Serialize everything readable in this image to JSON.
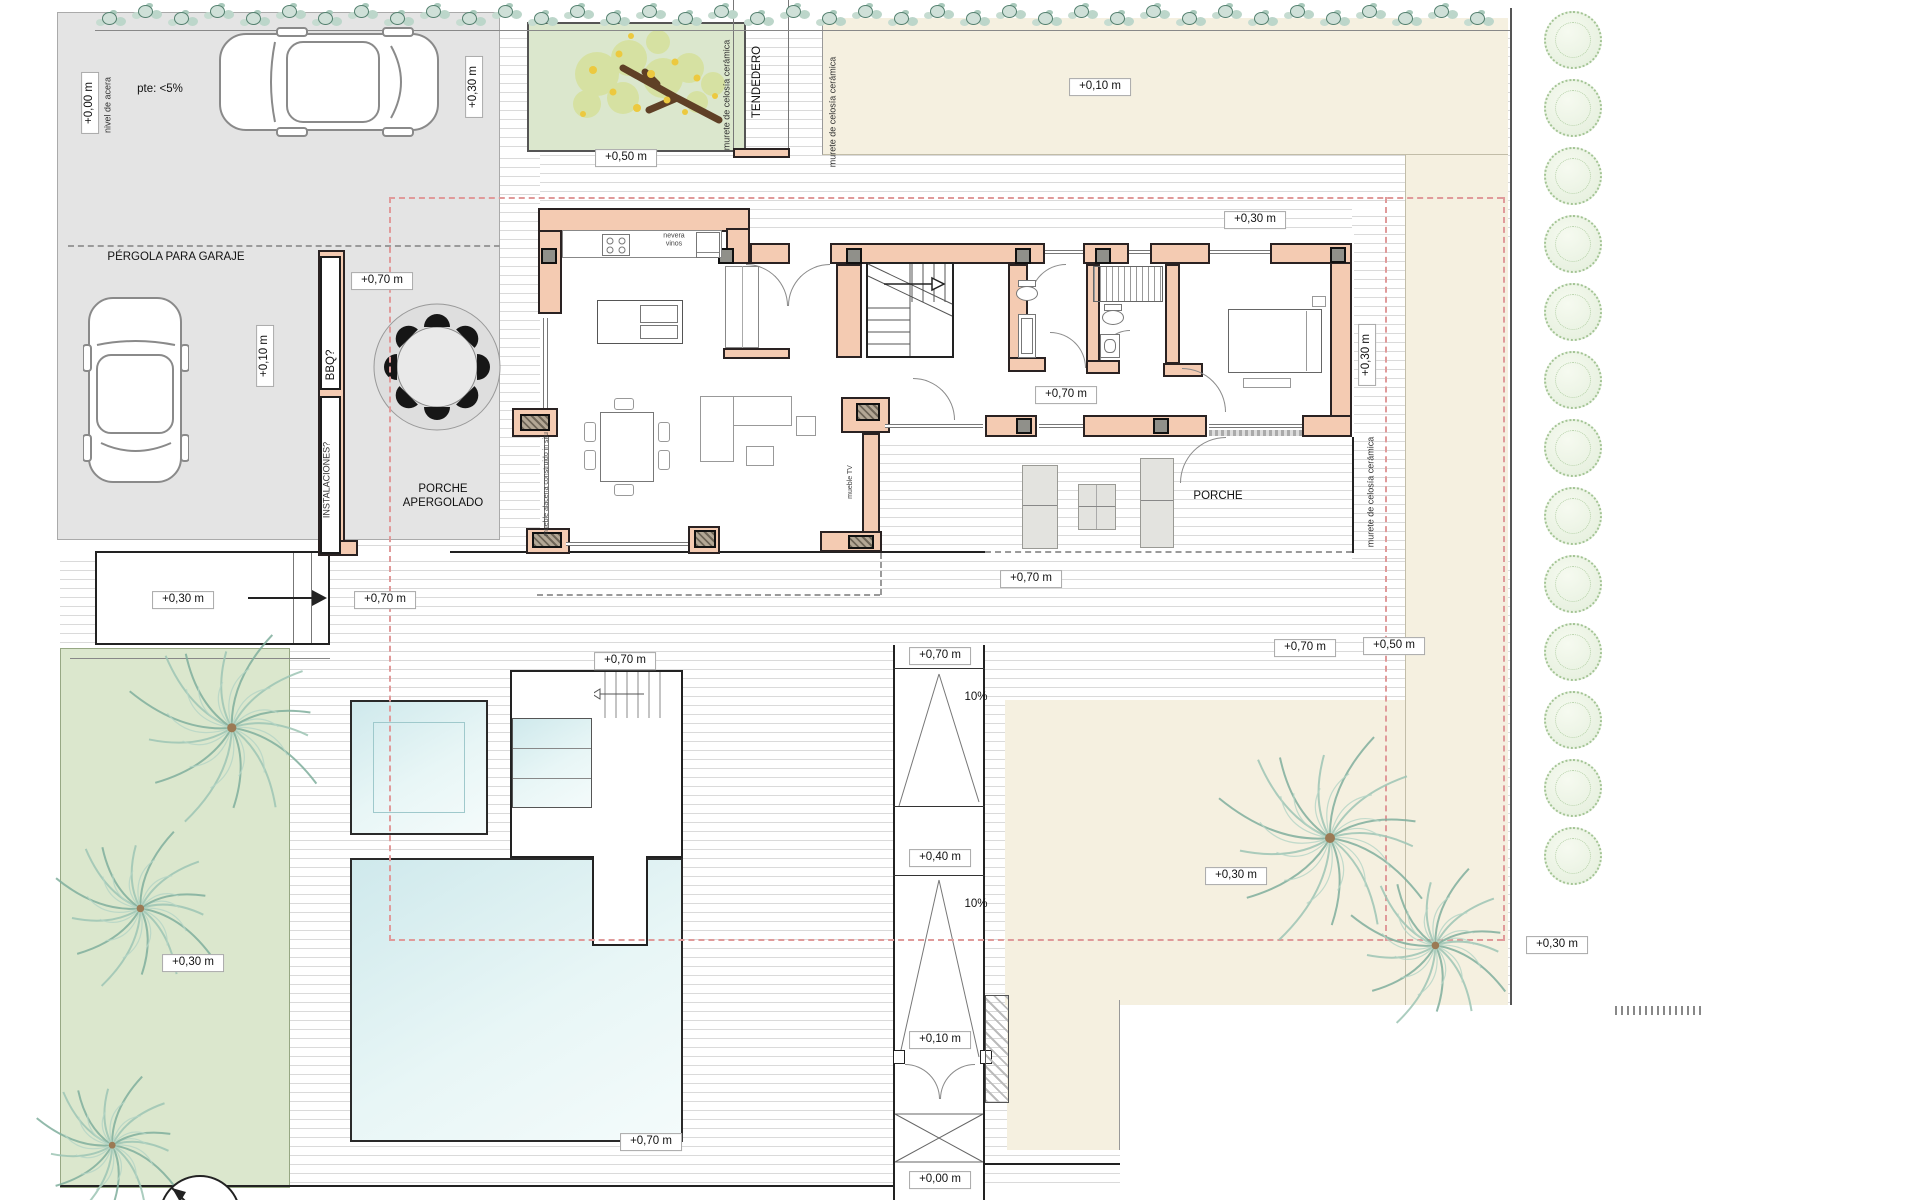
{
  "plan": {
    "type": "architectural site and ground-floor plan",
    "colors": {
      "wall_fill": "#f4cbb2",
      "wall_outline": "#2a2222",
      "pool_water": "#d7eef0",
      "terrain_beige": "#f5f0e0",
      "garden_green": "#dbe7cd",
      "driveway_gray": "#e4e4e4",
      "boundary_dashed": "#e09a9a"
    },
    "labels": [
      {
        "t": "+0,00 m",
        "x": 90,
        "y": 103,
        "r": 1,
        "b": 1,
        "n": "elevation-label"
      },
      {
        "t": "nivel de acera",
        "x": 108,
        "y": 105,
        "r": 1,
        "s": "small",
        "n": "note-nivel-acera"
      },
      {
        "t": "pte: <5%",
        "x": 160,
        "y": 90,
        "n": "note-slope-driveway"
      },
      {
        "t": "+0,30 m",
        "x": 474,
        "y": 87,
        "r": 1,
        "b": 1,
        "n": "elevation-label"
      },
      {
        "t": "PÉRGOLA PARA GARAJE",
        "x": 176,
        "y": 258,
        "n": "area-label-pergola-garaje"
      },
      {
        "t": "+0,10 m",
        "x": 265,
        "y": 356,
        "r": 1,
        "b": 1,
        "n": "elevation-label"
      },
      {
        "t": "+0,50 m",
        "x": 626,
        "y": 158,
        "b": 1,
        "n": "elevation-label"
      },
      {
        "t": "murete de celosía cerámica",
        "x": 727,
        "y": 95,
        "r": 1,
        "s": "small",
        "n": "note-murete-celosia"
      },
      {
        "t": "TENDEDERO",
        "x": 758,
        "y": 82,
        "r": 1,
        "n": "area-label-tendedero"
      },
      {
        "t": "murete de celosía cerámica",
        "x": 833,
        "y": 112,
        "r": 1,
        "s": "small",
        "n": "note-murete-celosia"
      },
      {
        "t": "+0,10 m",
        "x": 1100,
        "y": 87,
        "b": 1,
        "n": "elevation-label"
      },
      {
        "t": "+0,30 m",
        "x": 1255,
        "y": 220,
        "b": 1,
        "n": "elevation-label"
      },
      {
        "t": "+0,70 m",
        "x": 382,
        "y": 281,
        "b": 1,
        "n": "elevation-label"
      },
      {
        "t": "BBQ?",
        "x": 332,
        "y": 365,
        "r": 1,
        "n": "room-label-bbq"
      },
      {
        "t": "INSTALACIONES?",
        "x": 327,
        "y": 480,
        "r": 1,
        "s": "small",
        "n": "room-label-instalaciones"
      },
      {
        "t": "PORCHE\nAPERGOLADO",
        "x": 443,
        "y": 497,
        "n": "area-label-porche-apergolado"
      },
      {
        "t": "nevera\nvinos",
        "x": 674,
        "y": 241,
        "s": "tiny",
        "n": "note-nevera-vinos"
      },
      {
        "t": "+0,70 m",
        "x": 1066,
        "y": 395,
        "b": 1,
        "n": "elevation-label"
      },
      {
        "t": "mueble TV",
        "x": 851,
        "y": 482,
        "r": 1,
        "s": "tiny",
        "n": "note-mueble-tv"
      },
      {
        "t": "mueble alacena construido in situ",
        "x": 547,
        "y": 484,
        "r": 1,
        "s": "tiny",
        "n": "note-mueble-alacena"
      },
      {
        "t": "PORCHE",
        "x": 1218,
        "y": 497,
        "n": "area-label-porche"
      },
      {
        "t": "+0,70 m",
        "x": 1031,
        "y": 579,
        "b": 1,
        "n": "elevation-label"
      },
      {
        "t": "+0,30 m",
        "x": 1367,
        "y": 355,
        "r": 1,
        "b": 1,
        "n": "elevation-label"
      },
      {
        "t": "murete de celosía cerámica",
        "x": 1371,
        "y": 492,
        "r": 1,
        "s": "small",
        "n": "note-murete-celosia"
      },
      {
        "t": "+0,30 m",
        "x": 183,
        "y": 600,
        "b": 1,
        "n": "elevation-label"
      },
      {
        "t": "+0,70 m",
        "x": 385,
        "y": 600,
        "b": 1,
        "n": "elevation-label"
      },
      {
        "t": "+0,70 m",
        "x": 625,
        "y": 661,
        "b": 1,
        "n": "elevation-label"
      },
      {
        "t": "+0,70 m",
        "x": 940,
        "y": 656,
        "b": 1,
        "n": "elevation-label"
      },
      {
        "t": "+0,70 m",
        "x": 1305,
        "y": 648,
        "b": 1,
        "n": "elevation-label"
      },
      {
        "t": "+0,50 m",
        "x": 1394,
        "y": 646,
        "b": 1,
        "n": "elevation-label"
      },
      {
        "t": "10%",
        "x": 976,
        "y": 698,
        "n": "note-ramp-slope"
      },
      {
        "t": "+0,40 m",
        "x": 940,
        "y": 858,
        "b": 1,
        "n": "elevation-label"
      },
      {
        "t": "10%",
        "x": 976,
        "y": 905,
        "n": "note-ramp-slope"
      },
      {
        "t": "+0,30 m",
        "x": 1236,
        "y": 876,
        "b": 1,
        "n": "elevation-label"
      },
      {
        "t": "+0,30 m",
        "x": 1557,
        "y": 945,
        "b": 1,
        "n": "elevation-label"
      },
      {
        "t": "+0,30 m",
        "x": 193,
        "y": 963,
        "b": 1,
        "n": "elevation-label"
      },
      {
        "t": "+0,10 m",
        "x": 940,
        "y": 1040,
        "b": 1,
        "n": "elevation-label"
      },
      {
        "t": "+0,70 m",
        "x": 651,
        "y": 1142,
        "b": 1,
        "n": "elevation-label"
      },
      {
        "t": "+0,00 m",
        "x": 940,
        "y": 1180,
        "b": 1,
        "n": "elevation-label"
      }
    ]
  }
}
